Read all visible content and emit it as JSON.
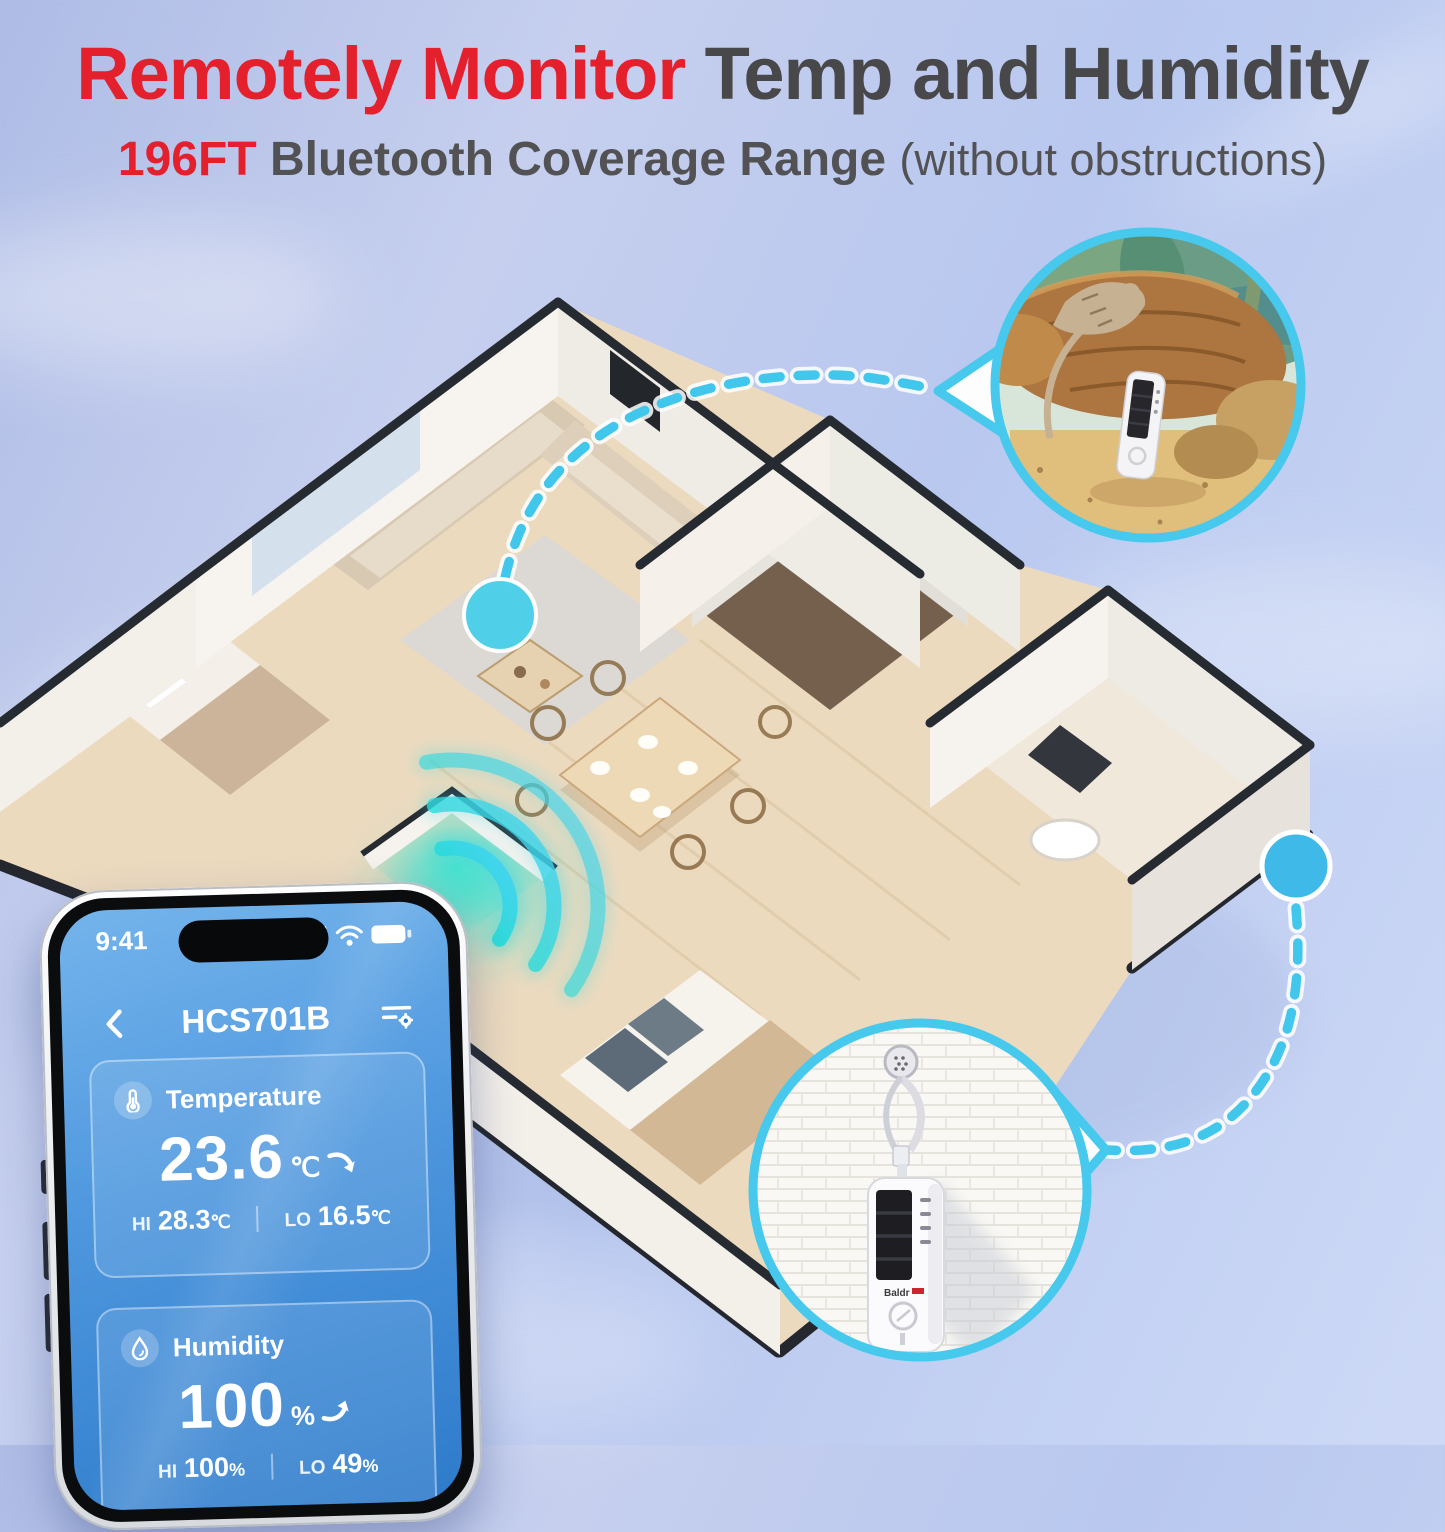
{
  "header": {
    "title_accent": "Remotely Monitor",
    "title_rest": " Temp and Humidity",
    "subtitle_range": "196FT",
    "subtitle_main": " Bluetooth Coverage Range ",
    "subtitle_note": "(without obstructions)",
    "accent_color": "#E4202D",
    "text_color": "#48484A"
  },
  "phone": {
    "status": {
      "time": "9:41",
      "icons": [
        "signal-bars-icon",
        "wifi-icon",
        "battery-icon"
      ]
    },
    "nav": {
      "back_icon": "chevron-left",
      "title": "HCS701B",
      "menu_icon": "filter-settings"
    },
    "cards": [
      {
        "icon": "thermometer-icon",
        "label": "Temperature",
        "value": "23.6",
        "unit": "℃",
        "trend": "down-arrow",
        "hi_label": "HI",
        "hi_value": "28.3",
        "hi_unit": "℃",
        "lo_label": "LO",
        "lo_value": "16.5",
        "lo_unit": "℃"
      },
      {
        "icon": "droplet-icon",
        "label": "Humidity",
        "value": "100",
        "unit": "%",
        "trend": "up-arrow",
        "hi_label": "HI",
        "hi_value": "100",
        "hi_unit": "%",
        "lo_label": "LO",
        "lo_value": "49",
        "lo_unit": "%"
      }
    ]
  },
  "scene": {
    "device_brand": "Baldr",
    "sensor_dots": [
      {
        "location": "living-room-coffee-table"
      },
      {
        "location": "exterior-right-wall"
      }
    ],
    "callouts": [
      {
        "name": "terrarium-sensor-closeup"
      },
      {
        "name": "wall-mounted-sensor-closeup"
      }
    ],
    "colors": {
      "accent_cyan": "#46C9EC",
      "dot_blue": "#3FBBE8",
      "wave_teal": "#16DFC8",
      "wall_white": "#F6F3EE",
      "wood_floor": "#ECDABF",
      "wall_cap": "#262A31"
    }
  }
}
